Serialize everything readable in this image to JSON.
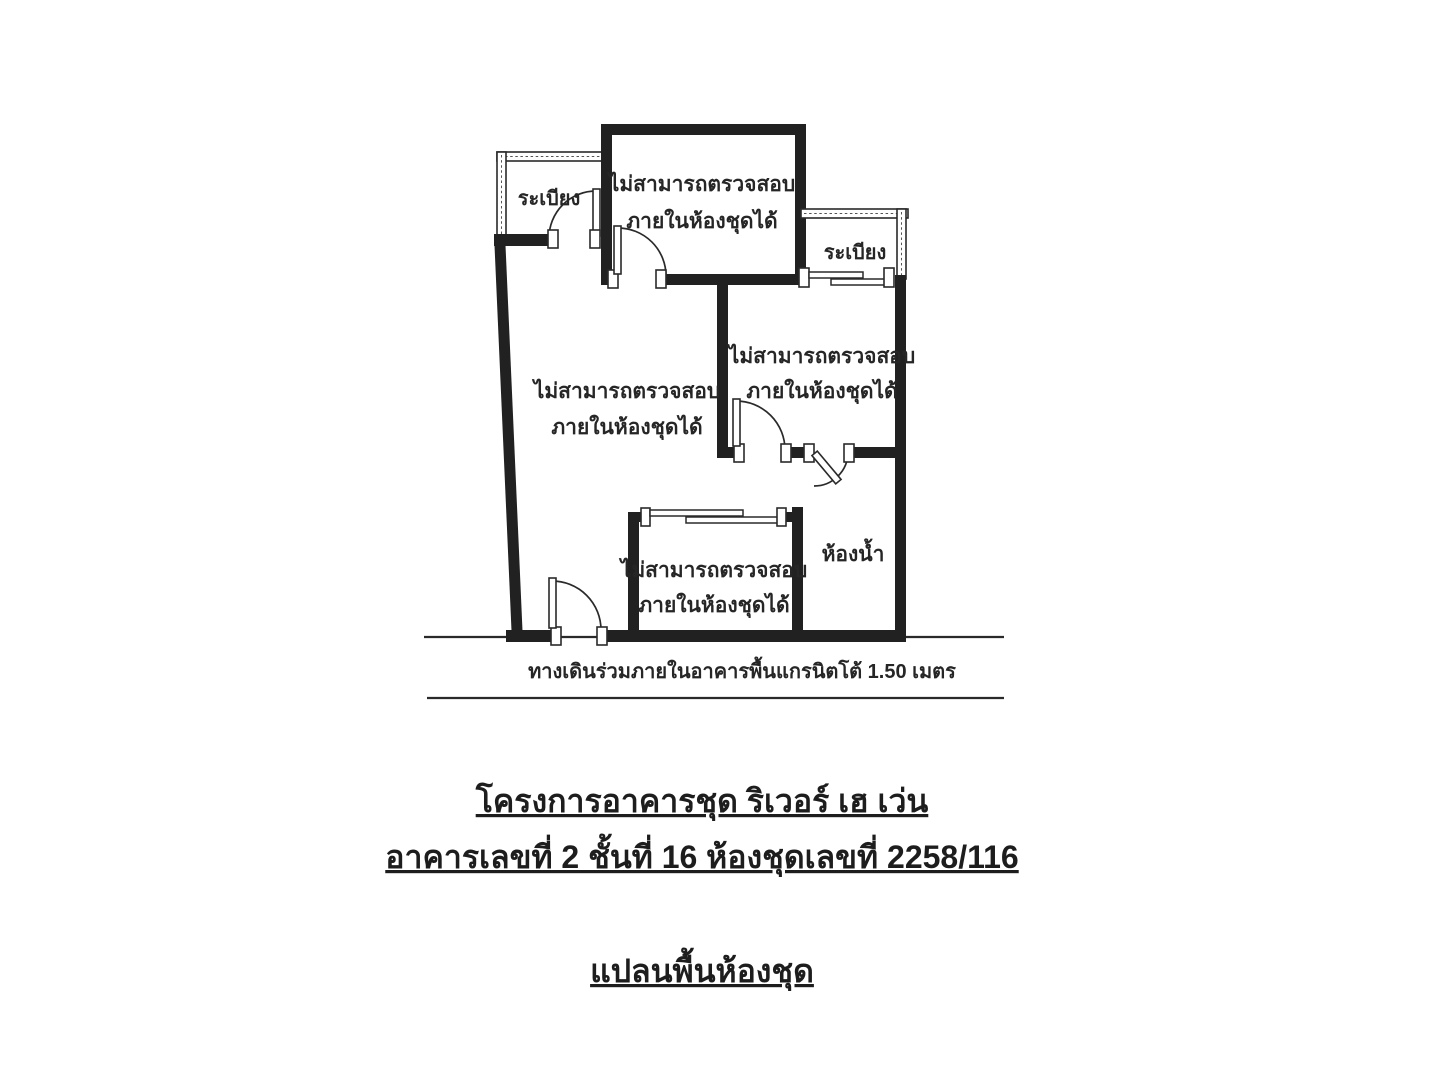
{
  "colors": {
    "wall": "#212121",
    "line": "#2a2a2a",
    "text": "#262626",
    "background": "#ffffff"
  },
  "plan": {
    "balconies": [
      {
        "position": "top-left",
        "label": "ระเบียง"
      },
      {
        "position": "right",
        "label": "ระเบียง"
      }
    ],
    "rooms": [
      {
        "name": "top-room",
        "label_line1": "ไม่สามารถตรวจสอบ",
        "label_line2": "ภายในห้องชุดได้"
      },
      {
        "name": "main-room",
        "label_line1": "ไม่สามารถตรวจสอบ",
        "label_line2": "ภายในห้องชุดได้"
      },
      {
        "name": "right-room",
        "label_line1": "ไม่สามารถตรวจสอบ",
        "label_line2": "ภายในห้องชุดได้"
      },
      {
        "name": "bottom-room",
        "label_line1": "ไม่สามารถตรวจสอบ",
        "label_line2": "ภายในห้องชุดได้"
      }
    ],
    "bathroom_label": "ห้องน้ำ",
    "corridor_note": "ทางเดินร่วมภายในอาคารพื้นแกรนิตโต้ 1.50 เมตร"
  },
  "titles": {
    "project_name": "โครงการอาคารชุด ริเวอร์ เฮ เว่น",
    "unit_info": "อาคารเลขที่ 2 ชั้นที่ 16 ห้องชุดเลขที่ 2258/116",
    "drawing_type": "แปลนพื้นห้องชุด"
  }
}
